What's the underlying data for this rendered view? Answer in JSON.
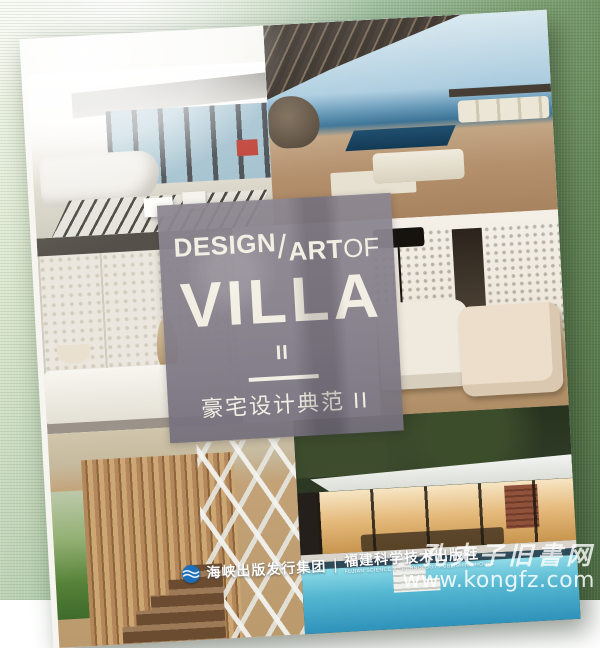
{
  "cover": {
    "title_en": {
      "word1": "DESIGN",
      "slash": "/",
      "word2": "ART",
      "word3": "OF",
      "main": "VILLA",
      "volume": "II"
    },
    "subtitle_cn": "豪宅设计典范 II",
    "panel_color": "#8a8490",
    "title_text_color": "#f2eee3"
  },
  "publisher": {
    "group_name": "海峡出版发行集团",
    "separator": "|",
    "house_name": "福建科学技术出版社",
    "house_name_en": "FUJIAN SCIENCE & TECHNOLOGY PUBLISHING HOUSE",
    "logo_color": "#1d6fb8"
  },
  "watermark": {
    "site_name": "孔夫子旧書网",
    "site_url": "www.kongfz.com"
  },
  "photos": {
    "living_room": "bright living room with panoramic windows and striped rug",
    "terrace": "seaside terrace with slatted pergola, infinity pool and daybeds",
    "lattice_room": "white lattice-screen lounge with daybed and vase",
    "armchair_room": "cream armchairs against perforated screen wall with black floor lamp",
    "staircase": "spiral staircase behind vertical timber slats with garden view",
    "pool_villa": "evening pool pavilion with warm lit interior"
  },
  "background": {
    "fabric_light": "#f4f7ea",
    "fabric_dark": "#4f6f46"
  }
}
